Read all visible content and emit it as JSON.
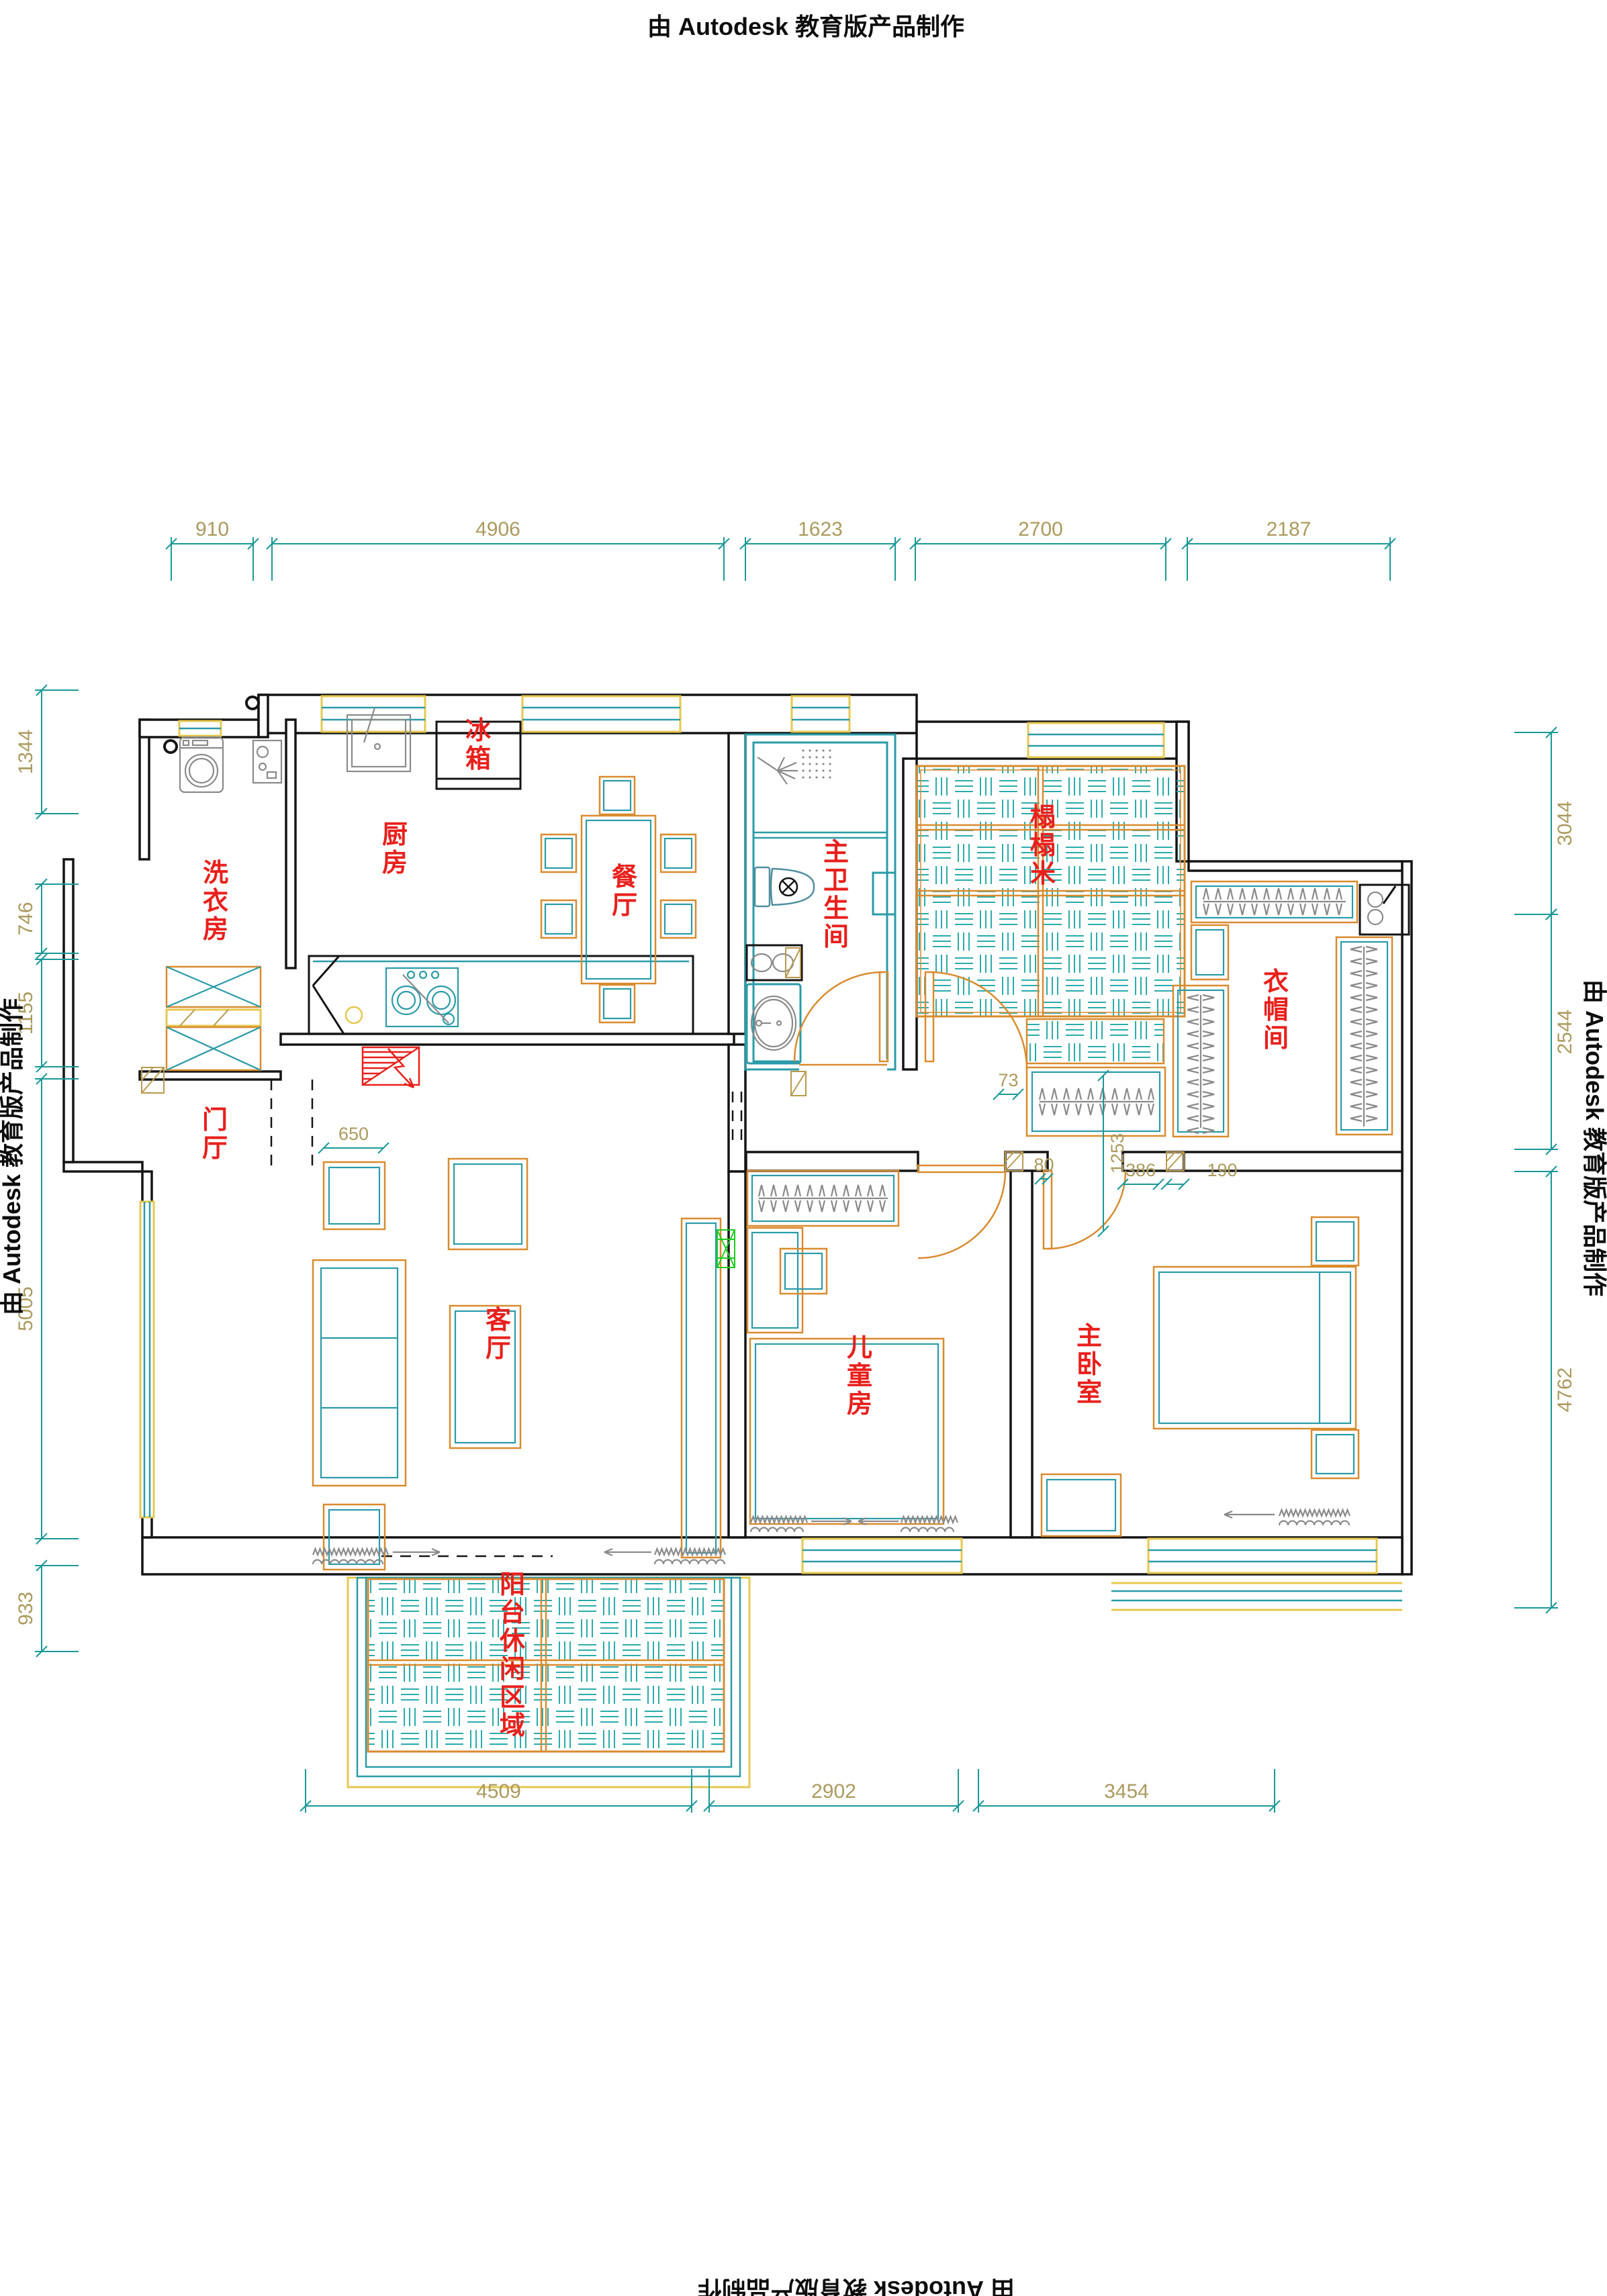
{
  "branding": {
    "top": "由 Autodesk 教育版产品制作",
    "left": "由 Autodesk 教育版产品制作",
    "right": "由 Autodesk 教育版产品制作",
    "bottom": "由 Autodesk 教育版产品制作"
  },
  "rooms": {
    "kitchen": "厨房",
    "laundry": "洗衣房",
    "dining": "餐厅",
    "fridge": "冰箱",
    "master_bath": "主卫生间",
    "tatami": "榻榻米",
    "closet": "衣帽间",
    "foyer": "门厅",
    "living": "客厅",
    "kids": "儿童房",
    "master_bed": "主卧室",
    "balcony": "阳台休闲区域"
  },
  "dims": {
    "top": [
      "910",
      "4906",
      "1623",
      "2700",
      "2187"
    ],
    "left": [
      "1344",
      "746",
      "1155",
      "5005",
      "933"
    ],
    "right": [
      "3044",
      "2544",
      "4762"
    ],
    "bottom": [
      "4509",
      "2902",
      "3454"
    ],
    "inner": [
      "650",
      "73",
      "1253",
      "80",
      "386",
      "190"
    ]
  },
  "colors": {
    "wall": "#141414",
    "window_frame": "#e6c84f",
    "window_glass": "#2a9ba8",
    "dim_line": "#1a9898",
    "dim_text": "#ab9a5e",
    "furniture_orange": "#d98b2e",
    "furniture_teal": "#2a9ba8",
    "hatch_teal": "#2aabab",
    "label_red": "#e8201c",
    "tv_green": "#1ecc1e",
    "fixture_gray": "#8a8a8a"
  }
}
